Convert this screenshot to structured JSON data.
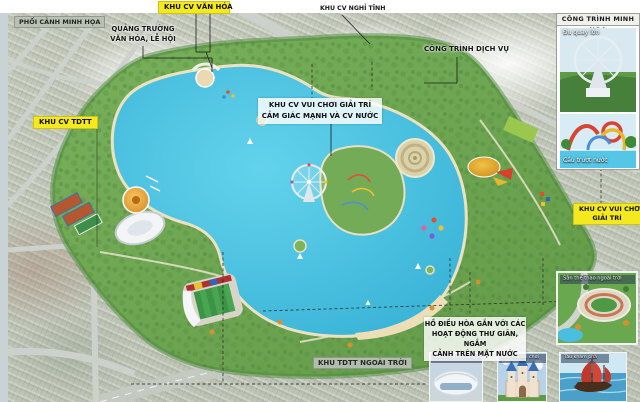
{
  "title_labels": {
    "van_hoa": "KHU CV VĂN HÓA",
    "nghi_tinh": "KHU CV NGHỈ TĨNH",
    "phoi_canh": "PHỐI CẢNH MINH HỌA",
    "tdtt": "KHU CV TDTT",
    "vui_choi_line1": "KHU CV VUI CHƠI",
    "vui_choi_line2": "GIẢI TRÍ",
    "tdtt_ngoai_troi": "KHU TDTT NGOÀI TRỜI"
  },
  "annotations": {
    "quang_truong": [
      "QUẢNG TRƯỜNG",
      "VĂN HÓA, LỄ HỘI"
    ],
    "dich_vu": "CÔNG TRÌNH DỊCH VỤ",
    "vui_choi_nuoc": [
      "KHU CV VUI CHƠI GIẢI TRÍ",
      "CẢM GIÁC MẠNH VÀ CV NƯỚC"
    ],
    "ho_dieu_hoa": [
      "HỒ ĐIỀU HÒA GẮN VỚI CÁC",
      "HOẠT ĐỘNG THƯ GIÃN, NGẮM",
      "CẢNH TRÊN MẶT NƯỚC"
    ]
  },
  "sidebar": {
    "title": "CÔNG TRÌNH MINH HỌA",
    "thumb_ferris": "Đu quay lớn",
    "thumb_slide": "Cầu trượt nước",
    "thumb_stadium": "Sân thể thao ngoài trời"
  },
  "bottom_thumbs": {
    "arena": "Nhà thi đấu trong nhà",
    "castle": "Lâu đài vui chơi",
    "ship": "Tàu khám phá"
  },
  "colors": {
    "lake": "#47bedf",
    "park_green": "#6fa854",
    "label_yellow": "#f4e81e",
    "urban": "#c6cbbd"
  }
}
